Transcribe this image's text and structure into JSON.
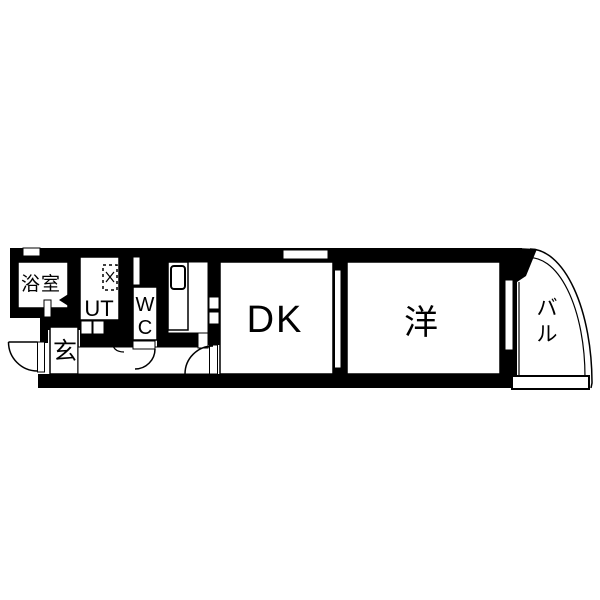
{
  "figure": {
    "type": "japanese-apartment-floor-plan"
  },
  "colors": {
    "wall": "#000000",
    "floor": "#ffffff",
    "line": "#000000"
  },
  "rooms": {
    "bathroom": {
      "label": "浴室"
    },
    "utility": {
      "label": "UT"
    },
    "toilet": {
      "label": "WC",
      "char1": "W",
      "char2": "C"
    },
    "entrance": {
      "label": "玄"
    },
    "dining_kitchen": {
      "label": "DK"
    },
    "western_room": {
      "label": "洋"
    },
    "balcony": {
      "label": "バル",
      "char1": "バ",
      "char2": "ル"
    }
  },
  "fixtures": [
    "kitchen-sink",
    "washing-machine-space",
    "entrance-door-swing",
    "wc-door-swing",
    "dk-door-swing",
    "bathroom-folding-door-marker",
    "sliding-door",
    "dk-window",
    "balcony-window",
    "balcony-railing-curve"
  ]
}
